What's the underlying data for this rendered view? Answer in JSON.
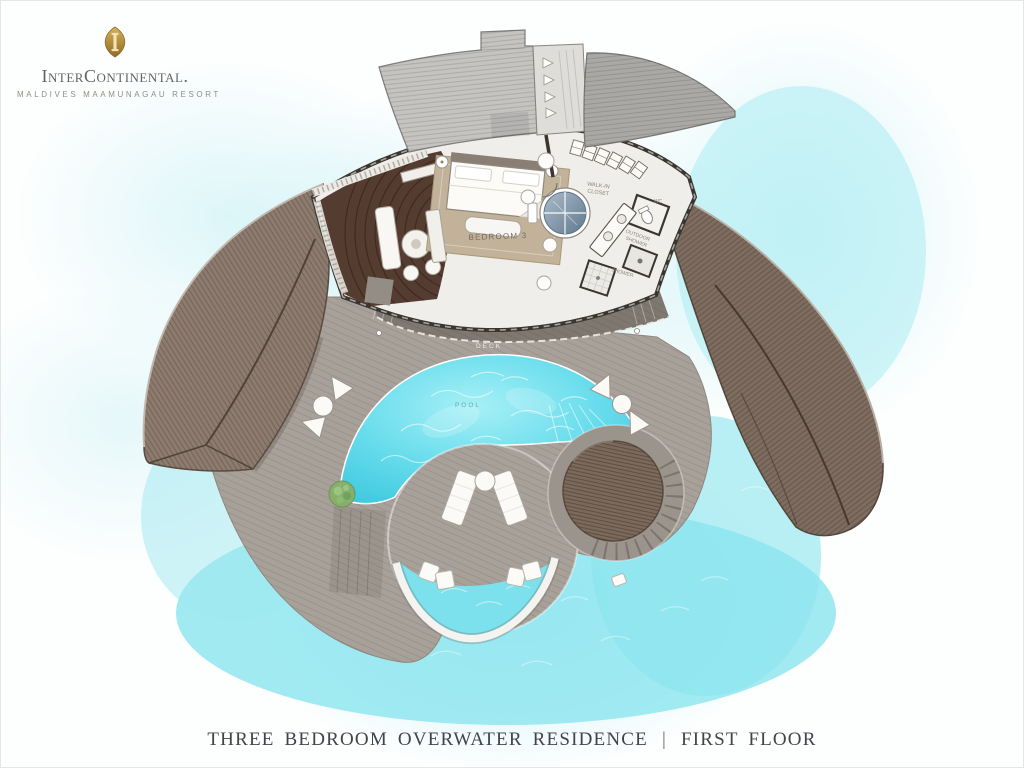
{
  "logo": {
    "brand": "InterContinental.",
    "tagline": "MALDIVES MAAMUNAGAU RESORT"
  },
  "title": {
    "residence": "THREE BEDROOM OVERWATER RESIDENCE",
    "divider": "|",
    "floor": "FIRST FLOOR"
  },
  "plan": {
    "labels": {
      "bedroom": "BEDROOM 3",
      "walk_in_line1": "WALK-IN",
      "walk_in_line2": "CLOSET",
      "wc": "WC",
      "outdoor_shower_line1": "OUTDOOR",
      "outdoor_shower_line2": "SHOWER",
      "shower": "SHOWER",
      "terrace": "TERRACE",
      "deck": "DECK",
      "pool": "POOL"
    }
  },
  "colors": {
    "gold": "#b5933f",
    "water_bright": "#8be5ef",
    "pool": "#55d2e6",
    "pool_light": "#a7f0f6",
    "deck": "#a8a19a",
    "terrace": "#7e7870",
    "roof_left": "#8c7b6e",
    "roof_right": "#7d6c5f",
    "roof_top_left": "#c4c3c0",
    "roof_top_right": "#a9a8a5",
    "lounge_floor": "#553c30",
    "daybed": "#7b6a5c",
    "rug": "#c2b29a",
    "wall": "#3a362f",
    "floor": "#efeeea",
    "title_text": "#43434c"
  }
}
